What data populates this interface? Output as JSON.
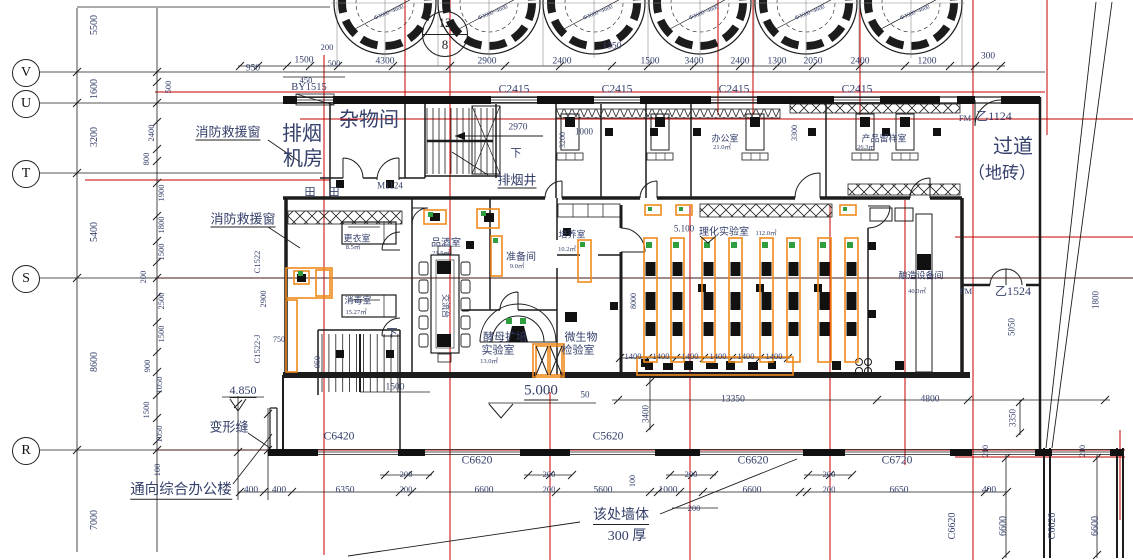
{
  "colors": {
    "axis_red": "#C40000",
    "equipment_orange": "#EE8A1C",
    "text_blue": "#35406B",
    "highlight_green": "#2F9E3F"
  },
  "axis_bubbles": [
    {
      "letter": "V",
      "x": 25,
      "y": 72
    },
    {
      "letter": "U",
      "x": 25,
      "y": 103
    },
    {
      "letter": "T",
      "x": 25,
      "y": 173
    },
    {
      "letter": "S",
      "x": 25,
      "y": 278
    },
    {
      "letter": "R",
      "x": 25,
      "y": 450
    }
  ],
  "detail_bubble": {
    "num": "12",
    "den": "8",
    "x": 444,
    "y": 33
  },
  "labels": [
    {
      "t": "5500",
      "x": 95,
      "y": 25,
      "s": 10,
      "r": -90
    },
    {
      "t": "1600",
      "x": 95,
      "y": 89,
      "s": 10,
      "r": -90
    },
    {
      "t": "3200",
      "x": 95,
      "y": 137,
      "s": 10,
      "r": -90
    },
    {
      "t": "5400",
      "x": 95,
      "y": 232,
      "s": 10,
      "r": -90
    },
    {
      "t": "8600",
      "x": 95,
      "y": 362,
      "s": 10,
      "r": -90
    },
    {
      "t": "7000",
      "x": 95,
      "y": 520,
      "s": 10,
      "r": -90
    },
    {
      "t": "500",
      "x": 168,
      "y": 87,
      "s": 8.5,
      "r": -90
    },
    {
      "t": "2400",
      "x": 151,
      "y": 133,
      "s": 8.5,
      "r": -90
    },
    {
      "t": "800",
      "x": 146,
      "y": 159,
      "s": 8.5,
      "r": -90
    },
    {
      "t": "1900",
      "x": 161,
      "y": 193,
      "s": 8.5,
      "r": -90
    },
    {
      "t": "1800",
      "x": 161,
      "y": 225,
      "s": 8.5,
      "r": -90
    },
    {
      "t": "1500",
      "x": 161,
      "y": 252,
      "s": 8.5,
      "r": -90
    },
    {
      "t": "200",
      "x": 143,
      "y": 277,
      "s": 8.5,
      "r": -90
    },
    {
      "t": "2500",
      "x": 161,
      "y": 301,
      "s": 8.5,
      "r": -90
    },
    {
      "t": "1500",
      "x": 161,
      "y": 334,
      "s": 8.5,
      "r": -90
    },
    {
      "t": "900",
      "x": 147,
      "y": 366,
      "s": 8.5,
      "r": -90
    },
    {
      "t": "1050",
      "x": 159,
      "y": 385,
      "s": 8.5,
      "r": -90
    },
    {
      "t": "1500",
      "x": 146,
      "y": 410,
      "s": 8.5,
      "r": -90
    },
    {
      "t": "1050",
      "x": 159,
      "y": 434,
      "s": 8.5,
      "r": -90
    },
    {
      "t": "100",
      "x": 157,
      "y": 470,
      "s": 8.5,
      "r": -90
    },
    {
      "t": "950",
      "x": 253,
      "y": 69
    },
    {
      "t": "1500",
      "x": 304,
      "y": 61
    },
    {
      "t": "200",
      "x": 327,
      "y": 47,
      "s": 8.5
    },
    {
      "t": "500",
      "x": 334,
      "y": 63,
      "s": 8.5
    },
    {
      "t": "450",
      "x": 306,
      "y": 80,
      "s": 8.5
    },
    {
      "t": "4300",
      "x": 385,
      "y": 62
    },
    {
      "t": "2900",
      "x": 487,
      "y": 62
    },
    {
      "t": "2400",
      "x": 562,
      "y": 62
    },
    {
      "t": "1350",
      "x": 612,
      "y": 47
    },
    {
      "t": "1500",
      "x": 650,
      "y": 62
    },
    {
      "t": "3400",
      "x": 694,
      "y": 62
    },
    {
      "t": "2400",
      "x": 740,
      "y": 62
    },
    {
      "t": "1300",
      "x": 777,
      "y": 62
    },
    {
      "t": "2050",
      "x": 813,
      "y": 62
    },
    {
      "t": "2400",
      "x": 860,
      "y": 62
    },
    {
      "t": "1200",
      "x": 927,
      "y": 62
    },
    {
      "t": "300",
      "x": 988,
      "y": 57
    },
    {
      "t": "BY1515",
      "x": 309,
      "y": 88,
      "s": 10.5,
      "n": "window-label-by1515"
    },
    {
      "t": "C2415",
      "x": 514,
      "y": 90,
      "s": 11.5,
      "n": "window-label-c2415"
    },
    {
      "t": "C2415",
      "x": 617,
      "y": 90,
      "s": 11.5,
      "n": "window-label-c2415"
    },
    {
      "t": "C2415",
      "x": 734,
      "y": 90,
      "s": 11.5,
      "n": "window-label-c2415"
    },
    {
      "t": "C2415",
      "x": 857,
      "y": 90,
      "s": 11.5,
      "n": "window-label-c2415"
    },
    {
      "t": "M1124",
      "x": 390,
      "y": 186,
      "s": 9,
      "n": "door-label-m1124"
    },
    {
      "t": "FM",
      "x": 965,
      "y": 118,
      "s": 8.5
    },
    {
      "t": "乙1124",
      "x": 994,
      "y": 116,
      "s": 12,
      "n": "door-label-yi1124"
    },
    {
      "t": "FM",
      "x": 966,
      "y": 291,
      "s": 8.5
    },
    {
      "t": "乙1524",
      "x": 1013,
      "y": 291,
      "s": 12,
      "n": "door-label-yi1524"
    },
    {
      "t": "排烟",
      "x": 302,
      "y": 134,
      "s": 20,
      "n": "room-smoke-exhaust-machine-room"
    },
    {
      "t": "机房",
      "x": 303,
      "y": 159,
      "s": 20
    },
    {
      "t": "杂物间",
      "x": 369,
      "y": 120,
      "s": 20,
      "n": "room-storage"
    },
    {
      "t": "过道",
      "x": 1013,
      "y": 147,
      "s": 20,
      "n": "room-corridor"
    },
    {
      "t": "（地砖）",
      "x": 1002,
      "y": 173,
      "s": 17
    },
    {
      "t": "排烟井",
      "x": 517,
      "y": 181,
      "s": 13,
      "u": 1,
      "n": "room-smoke-shaft"
    },
    {
      "t": "办公室",
      "x": 725,
      "y": 139,
      "s": 9,
      "n": "room-office"
    },
    {
      "t": "21.0㎡",
      "x": 722,
      "y": 148,
      "s": 6.5
    },
    {
      "t": "产品留样室",
      "x": 884,
      "y": 139,
      "s": 9,
      "n": "room-product-sample"
    },
    {
      "t": "26.3㎡",
      "x": 866,
      "y": 148,
      "s": 6.5
    },
    {
      "t": "品酒室",
      "x": 446,
      "y": 244,
      "s": 10,
      "n": "room-tasting"
    },
    {
      "t": "21.5㎡",
      "x": 441,
      "y": 254,
      "s": 6.5
    },
    {
      "t": "准备间",
      "x": 521,
      "y": 258,
      "s": 10,
      "n": "room-prep"
    },
    {
      "t": "9.0㎡",
      "x": 517,
      "y": 267,
      "s": 6.5
    },
    {
      "t": "培养室",
      "x": 572,
      "y": 235,
      "s": 9,
      "n": "room-culture"
    },
    {
      "t": "10.2㎡",
      "x": 567,
      "y": 250,
      "s": 6.5
    },
    {
      "t": "酵母扩培",
      "x": 505,
      "y": 338,
      "s": 11,
      "n": "room-yeast-lab"
    },
    {
      "t": "实验室",
      "x": 498,
      "y": 351,
      "s": 11
    },
    {
      "t": "13.0㎡",
      "x": 489,
      "y": 362,
      "s": 6.5
    },
    {
      "t": "微生物",
      "x": 581,
      "y": 338,
      "s": 11,
      "n": "room-microbiology"
    },
    {
      "t": "检验室",
      "x": 578,
      "y": 351,
      "s": 11
    },
    {
      "t": "理化实验室",
      "x": 724,
      "y": 233,
      "s": 10,
      "n": "room-physchem-lab"
    },
    {
      "t": "112.0㎡",
      "x": 766,
      "y": 234,
      "s": 6.5
    },
    {
      "t": "5.100",
      "x": 684,
      "y": 229,
      "s": 9
    },
    {
      "t": "酿造设备间",
      "x": 921,
      "y": 276,
      "s": 9,
      "n": "room-brewing-equipment"
    },
    {
      "t": "40.3㎡",
      "x": 917,
      "y": 292,
      "s": 6.5
    },
    {
      "t": "消毒室",
      "x": 358,
      "y": 301,
      "s": 9,
      "n": "room-disinfection"
    },
    {
      "t": "15.27㎡",
      "x": 356,
      "y": 313,
      "s": 6.5
    },
    {
      "t": "更衣室",
      "x": 357,
      "y": 239,
      "s": 9,
      "n": "room-changing"
    },
    {
      "t": "8.5㎡",
      "x": 353,
      "y": 248,
      "s": 6.5
    },
    {
      "t": "交流台",
      "x": 445,
      "y": 306,
      "s": 8,
      "r": 90
    },
    {
      "t": "消防救援窗",
      "x": 228,
      "y": 133,
      "s": 13,
      "u": 1,
      "n": "note-fire-rescue-window"
    },
    {
      "t": "消防救援窗",
      "x": 243,
      "y": 220,
      "s": 13,
      "u": 1,
      "n": "note-fire-rescue-window"
    },
    {
      "t": "变形缝",
      "x": 229,
      "y": 427,
      "s": 13,
      "n": "note-deformation-joint"
    },
    {
      "t": "通向综合办公楼",
      "x": 181,
      "y": 491,
      "s": 14.5,
      "u": 1,
      "n": "note-to-office-building"
    },
    {
      "t": "该处墙体",
      "x": 621,
      "y": 517,
      "s": 14,
      "u": 1,
      "n": "note-wall-here"
    },
    {
      "t": "300 厚",
      "x": 627,
      "y": 537,
      "s": 14
    },
    {
      "t": "下",
      "x": 516,
      "y": 154,
      "s": 11,
      "n": "stair-down-mark"
    },
    {
      "t": "下",
      "x": 392,
      "y": 334,
      "s": 11,
      "n": "stair-down-mark"
    },
    {
      "t": "田",
      "x": 310,
      "y": 193,
      "s": 11
    },
    {
      "t": "田",
      "x": 334,
      "y": 193,
      "s": 11
    },
    {
      "t": "4.850",
      "x": 243,
      "y": 391,
      "s": 12,
      "u": 1,
      "n": "level-4850"
    },
    {
      "t": "5.000",
      "x": 541,
      "y": 392,
      "s": 15,
      "u": 1,
      "n": "level-5000"
    },
    {
      "t": "2970",
      "x": 518,
      "y": 128
    },
    {
      "t": "1000",
      "x": 584,
      "y": 132,
      "s": 9
    },
    {
      "t": "3200",
      "x": 563,
      "y": 140,
      "s": 8,
      "r": -90
    },
    {
      "t": "3300",
      "x": 795,
      "y": 133,
      "s": 8,
      "r": -90
    },
    {
      "t": "1500",
      "x": 395,
      "y": 388
    },
    {
      "t": "750",
      "x": 279,
      "y": 340,
      "s": 8
    },
    {
      "t": "950",
      "x": 318,
      "y": 362,
      "s": 8,
      "r": -90
    },
    {
      "t": "8000",
      "x": 634,
      "y": 301,
      "s": 8,
      "r": -90
    },
    {
      "t": "5050",
      "x": 1012,
      "y": 327,
      "s": 9,
      "r": -90
    },
    {
      "t": "1800",
      "x": 1096,
      "y": 300,
      "s": 9,
      "r": -90
    },
    {
      "t": "C1522",
      "x": 257,
      "y": 262,
      "s": 8.5,
      "r": -90
    },
    {
      "t": "2900",
      "x": 263,
      "y": 299,
      "s": 8.5,
      "r": -90
    },
    {
      "t": "C1522-J",
      "x": 257,
      "y": 349,
      "s": 8.5,
      "r": -90
    },
    {
      "t": "1400",
      "x": 633,
      "y": 356,
      "s": 8.5
    },
    {
      "t": "1400",
      "x": 661,
      "y": 356,
      "s": 8.5
    },
    {
      "t": "1400",
      "x": 690,
      "y": 356,
      "s": 8.5
    },
    {
      "t": "1400",
      "x": 718,
      "y": 356,
      "s": 8.5
    },
    {
      "t": "1400",
      "x": 746,
      "y": 356,
      "s": 8.5
    },
    {
      "t": "1400",
      "x": 774,
      "y": 356,
      "s": 8.5
    },
    {
      "t": "50",
      "x": 585,
      "y": 395,
      "s": 9
    },
    {
      "t": "13350",
      "x": 733,
      "y": 400
    },
    {
      "t": "4800",
      "x": 930,
      "y": 400
    },
    {
      "t": "3400",
      "x": 646,
      "y": 414,
      "s": 9,
      "r": -90
    },
    {
      "t": "3350",
      "x": 1013,
      "y": 418,
      "s": 9,
      "r": -90
    },
    {
      "t": "400",
      "x": 251,
      "y": 491
    },
    {
      "t": "400",
      "x": 279,
      "y": 491
    },
    {
      "t": "6350",
      "x": 345,
      "y": 491
    },
    {
      "t": "200",
      "x": 406,
      "y": 474,
      "s": 8.5
    },
    {
      "t": "200",
      "x": 406,
      "y": 489,
      "s": 8.5
    },
    {
      "t": "6600",
      "x": 484,
      "y": 491
    },
    {
      "t": "200",
      "x": 549,
      "y": 474,
      "s": 8.5
    },
    {
      "t": "200",
      "x": 549,
      "y": 489,
      "s": 8.5
    },
    {
      "t": "5600",
      "x": 603,
      "y": 491
    },
    {
      "t": "100",
      "x": 633,
      "y": 481,
      "s": 8,
      "r": -90
    },
    {
      "t": "1000",
      "x": 668,
      "y": 491
    },
    {
      "t": "200",
      "x": 691,
      "y": 474,
      "s": 8.5
    },
    {
      "t": "200",
      "x": 694,
      "y": 508,
      "s": 8.5
    },
    {
      "t": "6600",
      "x": 752,
      "y": 491
    },
    {
      "t": "200",
      "x": 829,
      "y": 474,
      "s": 8.5
    },
    {
      "t": "200",
      "x": 829,
      "y": 489,
      "s": 8.5
    },
    {
      "t": "6650",
      "x": 899,
      "y": 491
    },
    {
      "t": "400",
      "x": 989,
      "y": 491
    },
    {
      "t": "210",
      "x": 986,
      "y": 451,
      "s": 8,
      "r": -90
    },
    {
      "t": "210",
      "x": 1083,
      "y": 451,
      "s": 8,
      "r": -90
    },
    {
      "t": "C6420",
      "x": 339,
      "y": 437,
      "s": 11.5,
      "n": "window-label-c6420"
    },
    {
      "t": "C6620",
      "x": 477,
      "y": 461,
      "s": 11.5,
      "n": "window-label-c6620"
    },
    {
      "t": "C5620",
      "x": 608,
      "y": 437,
      "s": 11.5,
      "n": "window-label-c5620"
    },
    {
      "t": "C6620",
      "x": 753,
      "y": 461,
      "s": 11.5,
      "n": "window-label-c6620"
    },
    {
      "t": "C6720",
      "x": 897,
      "y": 461,
      "s": 11.5,
      "n": "window-label-c6720"
    },
    {
      "t": "C6620",
      "x": 953,
      "y": 526,
      "s": 10,
      "r": -90,
      "n": "window-label-c6620"
    },
    {
      "t": "6600",
      "x": 1004,
      "y": 526,
      "s": 10,
      "r": -90
    },
    {
      "t": "C6620",
      "x": 1053,
      "y": 526,
      "s": 10,
      "r": -90,
      "n": "window-label-c6620"
    },
    {
      "t": "6600",
      "x": 1096,
      "y": 526,
      "s": 10,
      "r": -90
    },
    {
      "t": "Φ3600~4600",
      "x": 389,
      "y": 13,
      "s": 6,
      "r": -22,
      "n": "tank-spec"
    },
    {
      "t": "Φ3600~4600",
      "x": 493,
      "y": 13,
      "s": 6,
      "r": -22,
      "n": "tank-spec"
    },
    {
      "t": "Φ3600~4600",
      "x": 598,
      "y": 13,
      "s": 6,
      "r": -22,
      "n": "tank-spec"
    },
    {
      "t": "Φ3600~4600",
      "x": 704,
      "y": 13,
      "s": 6,
      "r": -22,
      "n": "tank-spec"
    },
    {
      "t": "Φ3600~4600",
      "x": 810,
      "y": 13,
      "s": 6,
      "r": -22,
      "n": "tank-spec"
    },
    {
      "t": "Φ3600~4600",
      "x": 915,
      "y": 13,
      "s": 6,
      "r": -22,
      "n": "tank-spec"
    }
  ]
}
